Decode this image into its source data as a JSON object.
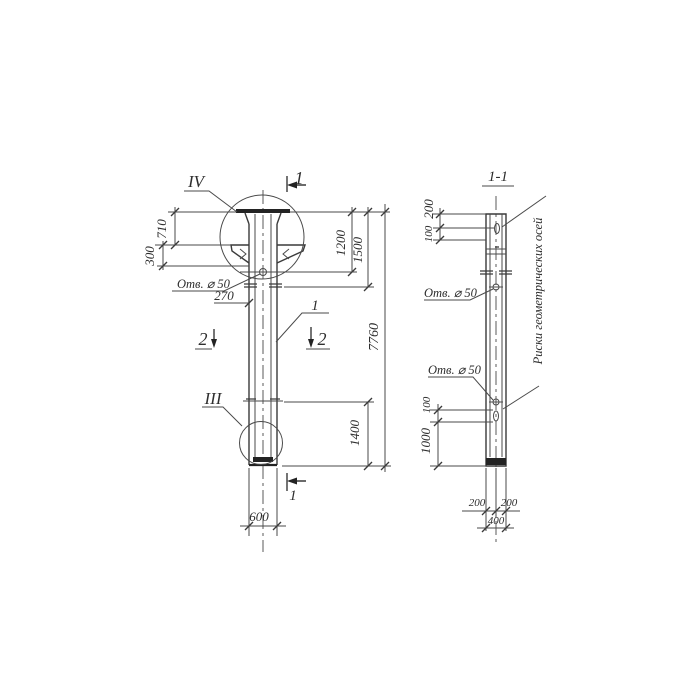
{
  "front": {
    "detail_top": "IV",
    "detail_bottom": "III",
    "sec1_top": "1",
    "sec1_bottom": "1",
    "sec2_left": "2",
    "sec2_right": "2",
    "pos1": "1",
    "hole_note": "Отв. ⌀ 50",
    "dim_710": "710",
    "dim_300": "300",
    "dim_270": "270",
    "dim_1200": "1200",
    "dim_1500": "1500",
    "dim_7760": "7760",
    "dim_1400": "1400",
    "dim_600": "600"
  },
  "section": {
    "title": "1-1",
    "dim_200_top": "200",
    "dim_100_top": "100",
    "hole_note_top": "Отв. ⌀ 50",
    "hole_note_bottom": "Отв. ⌀ 50",
    "dim_100_bottom": "100",
    "dim_1000": "1000",
    "dim_200_bl": "200",
    "dim_200_br": "200",
    "dim_400": "400",
    "axes_note": "Риски геометрических осей"
  },
  "colors": {
    "line": "#4a4a4a",
    "thick": "#222222"
  }
}
